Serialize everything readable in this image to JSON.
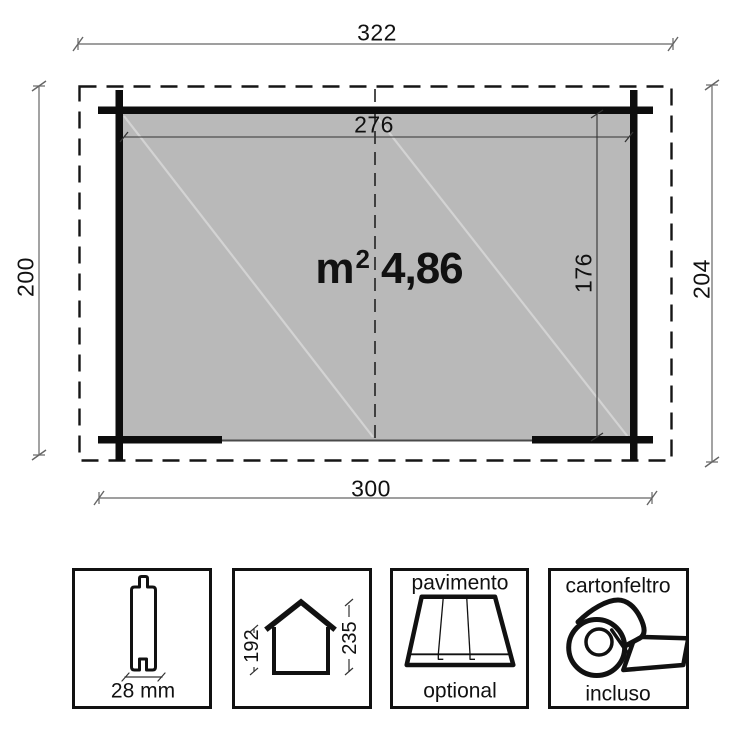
{
  "plan": {
    "overall_width": "322",
    "inner_width": "276",
    "base_width": "300",
    "depth_left": "200",
    "depth_right": "204",
    "inner_depth": "176",
    "area_unit": "m",
    "area_exponent": "2",
    "area_value": "4,86"
  },
  "panels": {
    "wall_thickness": {
      "value": "28 mm"
    },
    "elevation": {
      "eave_height": "192",
      "ridge_height": "235"
    },
    "floor": {
      "title": "pavimento",
      "note": "optional"
    },
    "roof_felt": {
      "title": "cartonfeltro",
      "note": "incluso"
    }
  },
  "colors": {
    "floor_fill": "#b9b9b9",
    "linework": "#111111",
    "dim_line": "#666666",
    "diagonal_line": "#d3d3d3"
  }
}
